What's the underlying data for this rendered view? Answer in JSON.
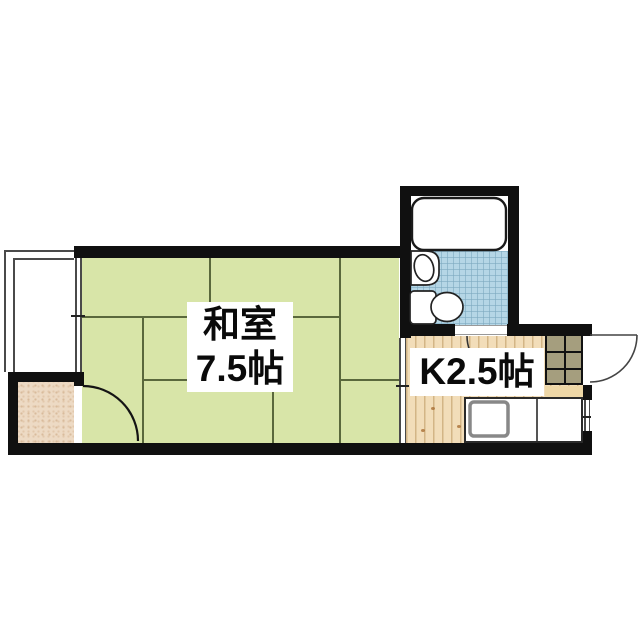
{
  "floorplan": {
    "rooms": {
      "washitsu": {
        "name": "和室",
        "size": "7.5帖"
      },
      "kitchen": {
        "label": "K2.5帖"
      }
    },
    "fixtures": [
      "bathtub",
      "washbasin",
      "toilet",
      "kitchen-sink",
      "kitchen-counter",
      "entrance-tile-floor",
      "step",
      "balcony",
      "storage-floor"
    ],
    "doors": [
      "washitsu-storage-door",
      "bathroom-door",
      "entrance-door"
    ],
    "windows": [
      "balcony-window",
      "kitchen-partition",
      "kitchen-window"
    ],
    "colors": {
      "wall": "#101010",
      "tatami": "#d8e5a8",
      "tatami_line": "#5a683c",
      "wood_floor": "#f2ddb9",
      "bath_tile": "#b5d6e6",
      "entrance_tile": "#a59e7e",
      "storage_floor": "#eddac4",
      "step": "#eed7a6",
      "label_text": "#0a0a0a"
    }
  }
}
